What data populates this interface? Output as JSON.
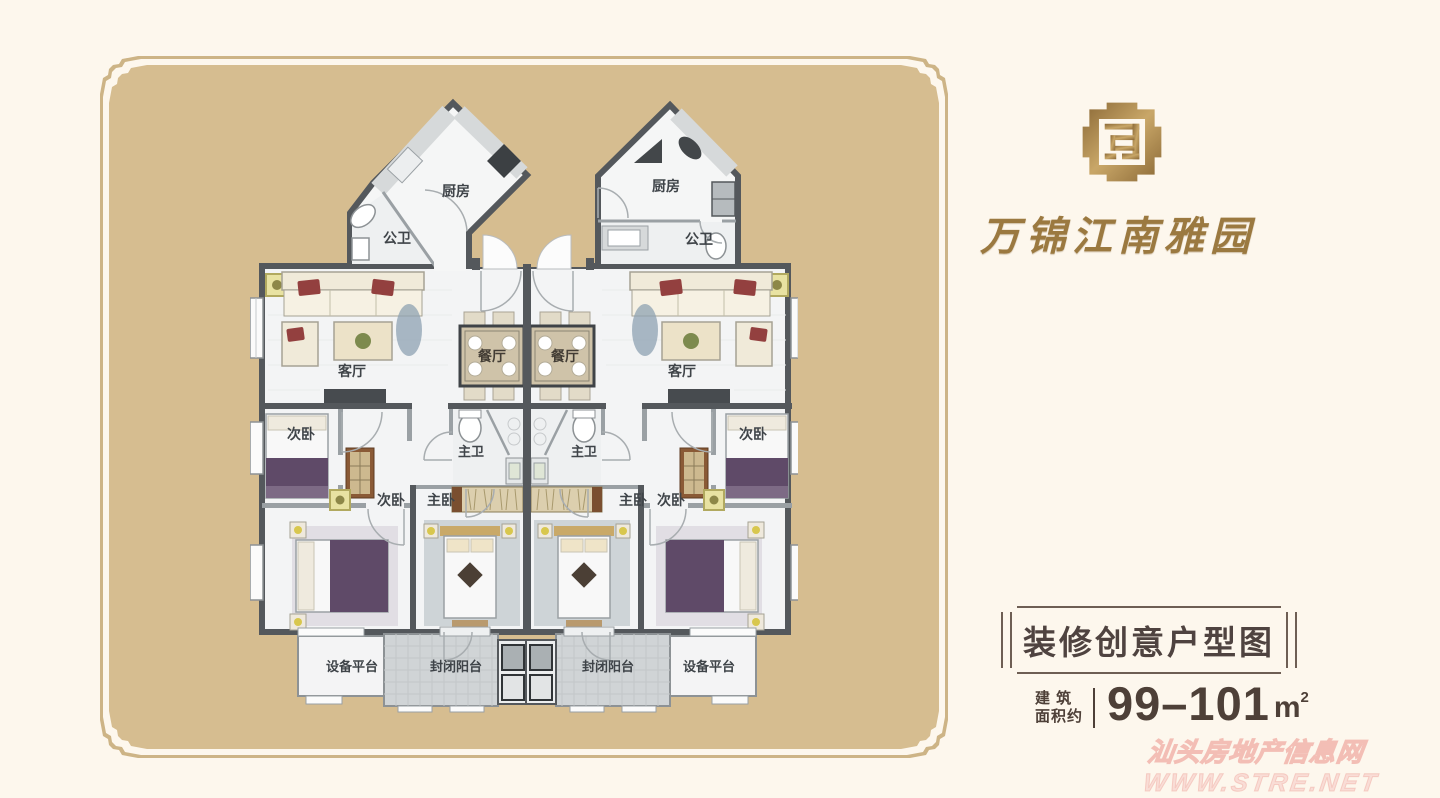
{
  "brand": {
    "emblem": "wanjin-gold-seal-emblem",
    "name": "万锦江南雅园"
  },
  "plan_info": {
    "title": "装修创意户型图",
    "area_label": [
      "建 筑",
      "面积约"
    ],
    "area_value": "99–101",
    "area_unit": "m",
    "area_exponent": "2"
  },
  "watermark": {
    "site_name": "汕头房地产信息网",
    "site_url": "WWW.STRE.NET"
  },
  "floorplan": {
    "rooms": {
      "kitchen": "厨房",
      "guest_bathroom": "公卫",
      "living_room": "客厅",
      "dining_room": "餐厅",
      "secondary_bedroom": "次卧",
      "master_bedroom": "主卧",
      "master_bathroom": "主卫",
      "equipment_platform": "设备平台",
      "enclosed_balcony": "封闭阳台"
    }
  },
  "colors": {
    "background": "#fdf7ed",
    "panel": "#d6bd90",
    "gold": "#9b7940",
    "text_dark": "#4f4340",
    "wall_dark": "#54585c",
    "watermark_pink": "#f0b0a8"
  }
}
